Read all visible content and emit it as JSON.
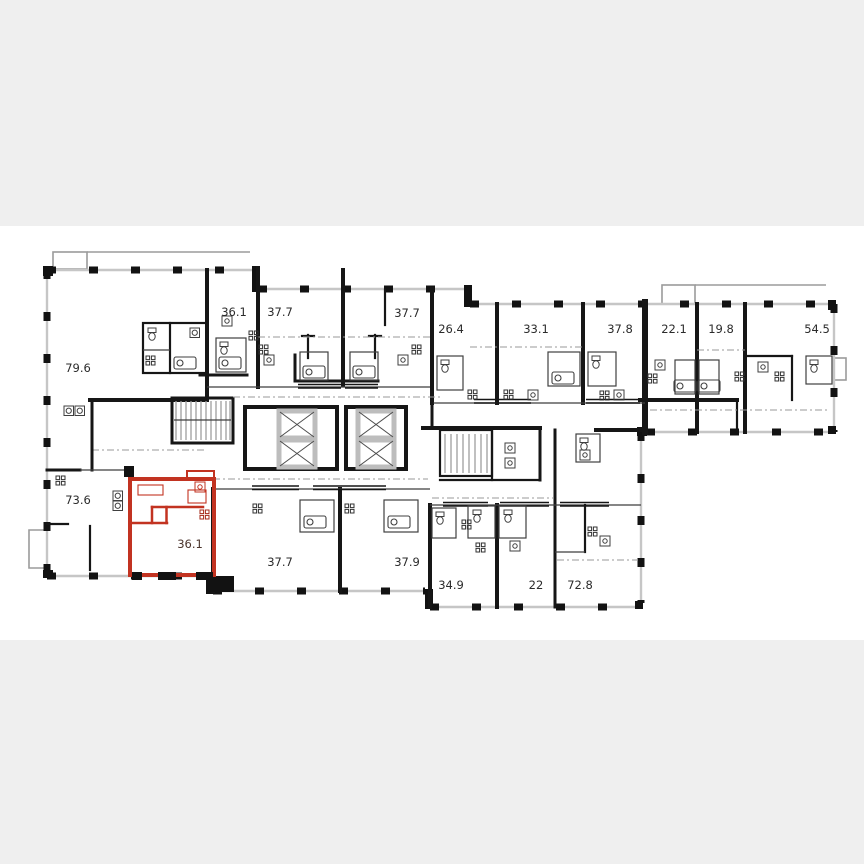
{
  "scene": {
    "type": "building-floor-plan",
    "description": "Multi-unit residential floor plan with one highlighted apartment"
  },
  "colors": {
    "background": "#ffffff",
    "band": "#efefef",
    "wall": "#161616",
    "facade_line": "#c6c6c6",
    "highlight_fill": "#f39e8b",
    "highlight_wall": "#c23321",
    "label": "#2b2b2b",
    "highlight_label": "#4a332b"
  },
  "units": [
    {
      "id": "unit-79-6",
      "area": "79.6",
      "highlighted": false
    },
    {
      "id": "unit-36-1-top",
      "area": "36.1",
      "highlighted": false
    },
    {
      "id": "unit-37-7-top-left",
      "area": "37.7",
      "highlighted": false
    },
    {
      "id": "unit-37-7-top-right",
      "area": "37.7",
      "highlighted": false
    },
    {
      "id": "unit-26-4",
      "area": "26.4",
      "highlighted": false
    },
    {
      "id": "unit-33-1",
      "area": "33.1",
      "highlighted": false
    },
    {
      "id": "unit-37-8",
      "area": "37.8",
      "highlighted": false
    },
    {
      "id": "unit-22-1",
      "area": "22.1",
      "highlighted": false
    },
    {
      "id": "unit-19-8",
      "area": "19.8",
      "highlighted": false
    },
    {
      "id": "unit-54-5",
      "area": "54.5",
      "highlighted": false
    },
    {
      "id": "unit-73-6",
      "area": "73.6",
      "highlighted": false
    },
    {
      "id": "unit-36-1-highlighted",
      "area": "36.1",
      "highlighted": true
    },
    {
      "id": "unit-37-7-bottom",
      "area": "37.7",
      "highlighted": false
    },
    {
      "id": "unit-37-9",
      "area": "37.9",
      "highlighted": false
    },
    {
      "id": "unit-34-9",
      "area": "34.9",
      "highlighted": false
    },
    {
      "id": "unit-22",
      "area": "22",
      "highlighted": false
    },
    {
      "id": "unit-72-8",
      "area": "72.8",
      "highlighted": false
    }
  ],
  "highlighted_unit": {
    "area": "36.1"
  }
}
